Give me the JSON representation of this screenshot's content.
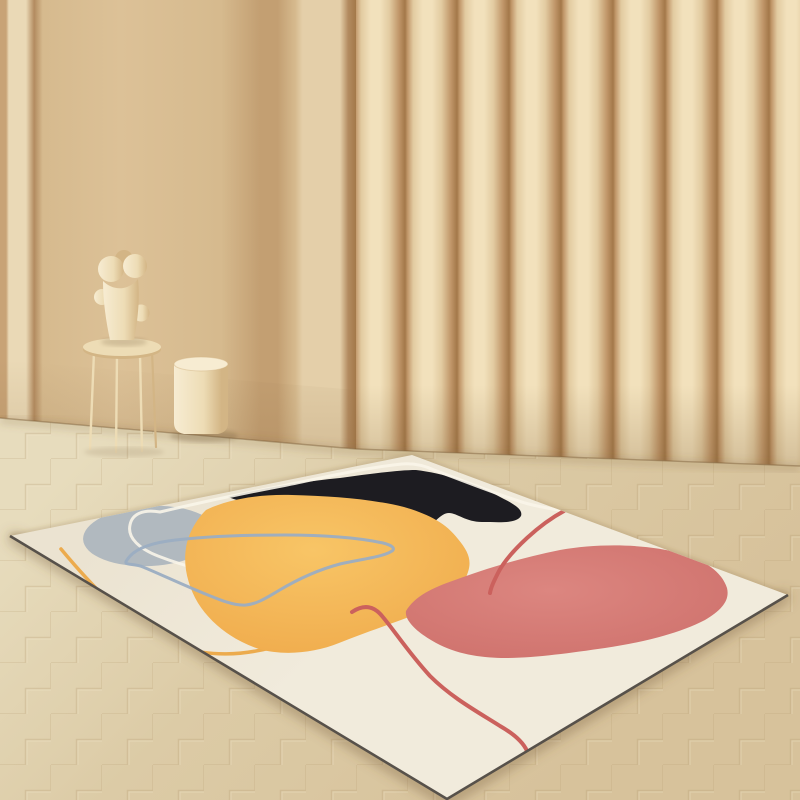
{
  "scene": {
    "kind": "product-photograph",
    "subject": "abstract-shapes-area-rug",
    "setting": "beige-room-with-curved-column-wall-and-herringbone-floor",
    "objects": [
      {
        "name": "flat-wall"
      },
      {
        "name": "curved-column-panels"
      },
      {
        "name": "herringbone-wood-floor"
      },
      {
        "name": "blob-sculpture"
      },
      {
        "name": "thin-leg-side-table"
      },
      {
        "name": "cylindrical-pedestal"
      },
      {
        "name": "area-rug"
      },
      {
        "name": "rug-black-blob"
      },
      {
        "name": "rug-gray-blob"
      },
      {
        "name": "rug-yellow-blob"
      },
      {
        "name": "rug-pink-blob"
      },
      {
        "name": "rug-blue-loop-line"
      },
      {
        "name": "rug-yellow-contour-line"
      },
      {
        "name": "rug-white-contour-line"
      },
      {
        "name": "rug-red-contour-lines"
      }
    ]
  },
  "palette": {
    "wall_edge_dark": "#c8a376",
    "wall_strip_light": "#ead9b6",
    "wall_seam_dark": "#b38b60",
    "wall_main": "#d6ba8e",
    "wall_main_light": "#dcc197",
    "wall_band_dark": "#c39f72",
    "wall_panel_light": "#e4cfa9",
    "column_deep": "#a37849",
    "column_dark": "#c1976a",
    "column_mid": "#e2cba1",
    "column_light": "#f2e1bc",
    "floor_base": "#ddd0ae",
    "floor_top": "#e7dcbd",
    "floor_mid": "#dccba6",
    "floor_bottom": "#d7c29b",
    "floor_groove": "#b49a6e",
    "floor_groove_light": "#f4ead0",
    "junction_shadow": "#7a5a33",
    "rug_cream": "#f1ebdc",
    "rug_cream_top": "#ebe3d1",
    "rug_edge_dark": "#57514a",
    "blob_black": "#1d1c21",
    "blob_gray": "#b1b9bf",
    "blob_yellow_light": "#f8c566",
    "blob_yellow_deep": "#efa94a",
    "blob_pink_light": "#dc8680",
    "blob_pink_deep": "#cd6f6a",
    "line_red": "#cb615d",
    "line_yellow": "#ecab4d",
    "line_blue": "#9badc2",
    "line_white": "#f9f5e9",
    "object_cream_light": "#f7ecd2",
    "object_cream_mid": "#eddcb5",
    "object_cream_shade": "#d3b585",
    "shadow_soft": "#6e5535"
  }
}
